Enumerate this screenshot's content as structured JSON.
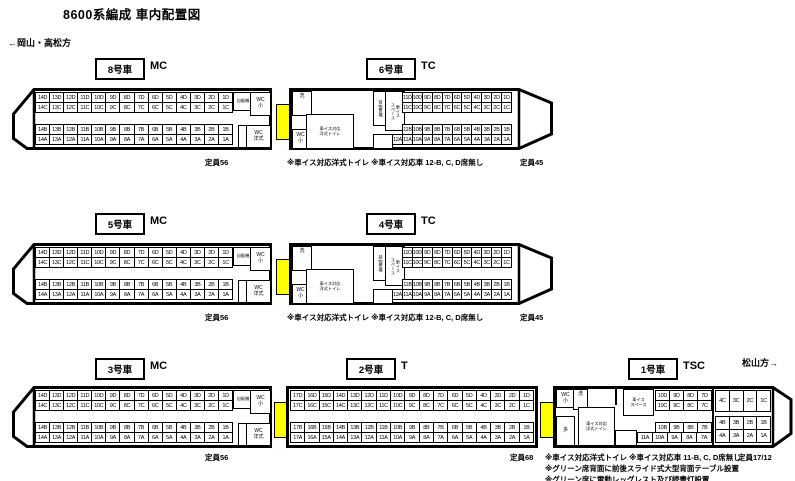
{
  "title": "8600系編成 車内配置図",
  "directions": {
    "left": "←岡山・高松方",
    "right": "松山方→"
  },
  "colors": {
    "gangway_yellow": "#ffff00"
  },
  "cars": [
    {
      "number": "8号車",
      "type": "MC",
      "capacity": "定員56",
      "facilities": {
        "vending": "自販機",
        "wc_small": "WC\n小",
        "wc_western": "WC\n洋式"
      },
      "seats": {
        "D": [
          "14D",
          "13D",
          "12D",
          "11D",
          "10D",
          "9D",
          "8D",
          "7D",
          "6D",
          "5D",
          "4D",
          "3D",
          "2D",
          "1D"
        ],
        "C": [
          "14C",
          "13C",
          "12C",
          "11C",
          "10C",
          "9C",
          "8C",
          "7C",
          "6C",
          "5C",
          "4C",
          "3C",
          "2C",
          "1C"
        ],
        "B": [
          "14B",
          "13B",
          "12B",
          "11B",
          "10B",
          "9B",
          "8B",
          "7B",
          "6B",
          "5B",
          "4B",
          "3B",
          "2B",
          "1B"
        ],
        "A": [
          "14A",
          "13A",
          "12A",
          "11A",
          "10A",
          "9A",
          "8A",
          "7A",
          "6A",
          "5A",
          "4A",
          "3A",
          "2A",
          "1A"
        ]
      }
    },
    {
      "number": "6号車",
      "type": "TC",
      "capacity": "定員45",
      "note": "※車イス対応洋式トイレ ※車イス対応車 12-B, C, D席無し",
      "facilities": {
        "wash": "洗",
        "wc_small": "WC\n小",
        "wheelchair_toilet": "車イス対応\n洋式トイレ",
        "luggage": "荷物置場",
        "wheelchair_space": "車イス\nスペース"
      },
      "seats": {
        "D": [
          "11D",
          "10D",
          "9D",
          "8D",
          "7D",
          "6D",
          "5D",
          "4D",
          "3D",
          "2D",
          "1D"
        ],
        "C": [
          "11C",
          "10C",
          "9C",
          "8C",
          "7C",
          "6C",
          "5C",
          "4C",
          "3C",
          "2C",
          "1C"
        ],
        "B": [
          "11B",
          "10B",
          "9B",
          "8B",
          "7B",
          "6B",
          "5B",
          "4B",
          "3B",
          "2B",
          "1B"
        ],
        "A": [
          "12A",
          "11A",
          "10A",
          "9A",
          "8A",
          "7A",
          "6A",
          "5A",
          "4A",
          "3A",
          "2A",
          "1A"
        ]
      }
    },
    {
      "number": "5号車",
      "type": "MC",
      "capacity": "定員56",
      "facilities": {
        "vending": "自販機",
        "wc_small": "WC\n小",
        "wc_western": "WC\n洋式"
      },
      "seats": {
        "D": [
          "14D",
          "13D",
          "12D",
          "11D",
          "10D",
          "9D",
          "8D",
          "7D",
          "6D",
          "5D",
          "4D",
          "3D",
          "2D",
          "1D"
        ],
        "C": [
          "14C",
          "13C",
          "12C",
          "11C",
          "10C",
          "9C",
          "8C",
          "7C",
          "6C",
          "5C",
          "4C",
          "3C",
          "2C",
          "1C"
        ],
        "B": [
          "14B",
          "13B",
          "12B",
          "11B",
          "10B",
          "9B",
          "8B",
          "7B",
          "6B",
          "5B",
          "4B",
          "3B",
          "2B",
          "1B"
        ],
        "A": [
          "14A",
          "13A",
          "12A",
          "11A",
          "10A",
          "9A",
          "8A",
          "7A",
          "6A",
          "5A",
          "4A",
          "3A",
          "2A",
          "1A"
        ]
      }
    },
    {
      "number": "4号車",
      "type": "TC",
      "capacity": "定員45",
      "note": "※車イス対応洋式トイレ ※車イス対応車 12-B, C, D席無し",
      "facilities": {
        "wash": "洗",
        "wc_small": "WC\n小",
        "wheelchair_toilet": "車イス対応\n洋式トイレ",
        "luggage": "荷物置場",
        "wheelchair_space": "車イス\nスペース"
      },
      "seats": {
        "D": [
          "11D",
          "10D",
          "9D",
          "8D",
          "7D",
          "6D",
          "5D",
          "4D",
          "3D",
          "2D",
          "1D"
        ],
        "C": [
          "11C",
          "10C",
          "9C",
          "8C",
          "7C",
          "6C",
          "5C",
          "4C",
          "3C",
          "2C",
          "1C"
        ],
        "B": [
          "11B",
          "10B",
          "9B",
          "8B",
          "7B",
          "6B",
          "5B",
          "4B",
          "3B",
          "2B",
          "1B"
        ],
        "A": [
          "12A",
          "11A",
          "10A",
          "9A",
          "8A",
          "7A",
          "6A",
          "5A",
          "4A",
          "3A",
          "2A",
          "1A"
        ]
      }
    },
    {
      "number": "3号車",
      "type": "MC",
      "capacity": "定員56",
      "facilities": {
        "vending": "自販機",
        "wc_small": "WC\n小",
        "wc_western": "WC\n洋式"
      },
      "seats": {
        "D": [
          "14D",
          "13D",
          "12D",
          "11D",
          "10D",
          "9D",
          "8D",
          "7D",
          "6D",
          "5D",
          "4D",
          "3D",
          "2D",
          "1D"
        ],
        "C": [
          "14C",
          "13C",
          "12C",
          "11C",
          "10C",
          "9C",
          "8C",
          "7C",
          "6C",
          "5C",
          "4C",
          "3C",
          "2C",
          "1C"
        ],
        "B": [
          "14B",
          "13B",
          "12B",
          "11B",
          "10B",
          "9B",
          "8B",
          "7B",
          "6B",
          "5B",
          "4B",
          "3B",
          "2B",
          "1B"
        ],
        "A": [
          "14A",
          "13A",
          "12A",
          "11A",
          "10A",
          "9A",
          "8A",
          "7A",
          "6A",
          "5A",
          "4A",
          "3A",
          "2A",
          "1A"
        ]
      }
    },
    {
      "number": "2号車",
      "type": "T",
      "capacity": "定員68",
      "seats": {
        "D": [
          "17D",
          "16D",
          "15D",
          "14D",
          "13D",
          "12D",
          "11D",
          "10D",
          "9D",
          "8D",
          "7D",
          "6D",
          "5D",
          "4D",
          "3D",
          "2D",
          "1D"
        ],
        "C": [
          "17C",
          "16C",
          "15C",
          "14C",
          "13C",
          "12C",
          "11C",
          "10C",
          "9C",
          "8C",
          "7C",
          "6C",
          "5C",
          "4C",
          "3C",
          "2C",
          "1C"
        ],
        "B": [
          "17B",
          "16B",
          "15B",
          "14B",
          "13B",
          "12B",
          "11B",
          "10B",
          "9B",
          "8B",
          "7B",
          "6B",
          "5B",
          "4B",
          "3B",
          "2B",
          "1B"
        ],
        "A": [
          "17A",
          "16A",
          "15A",
          "14A",
          "13A",
          "12A",
          "11A",
          "10A",
          "9A",
          "8A",
          "7A",
          "6A",
          "5A",
          "4A",
          "3A",
          "2A",
          "1A"
        ]
      }
    },
    {
      "number": "1号車",
      "type": "TSC",
      "capacity": "定員17/12",
      "notes": [
        "※車イス対応洋式トイレ ※車イス対応車 11-B, C, D席無し",
        "※グリーン席背面に前後スライド式大型背面テーブル設置",
        "※グリーン席に電動レッグレスト及び読書灯設置"
      ],
      "facilities": {
        "wc_small": "WC\n小",
        "wash": "洗",
        "multi": "多",
        "wheelchair_toilet": "車イス対応\n洋式トイレ",
        "wheelchair_space": "車イス\nスペース"
      },
      "seats": {
        "regular": {
          "D": [
            "10D",
            "9D",
            "8D",
            "7D"
          ],
          "C": [
            "10C",
            "9C",
            "8C",
            "7C"
          ],
          "B": [
            "10B",
            "9B",
            "8B",
            "7B"
          ],
          "A": [
            "11A",
            "10A",
            "9A",
            "8A",
            "7A"
          ]
        },
        "green": {
          "C": [
            "4C",
            "3C",
            "2C",
            "1C"
          ],
          "B": [
            "4B",
            "3B",
            "2B",
            "1B"
          ],
          "A": [
            "4A",
            "3A",
            "2A",
            "1A"
          ]
        }
      }
    }
  ]
}
